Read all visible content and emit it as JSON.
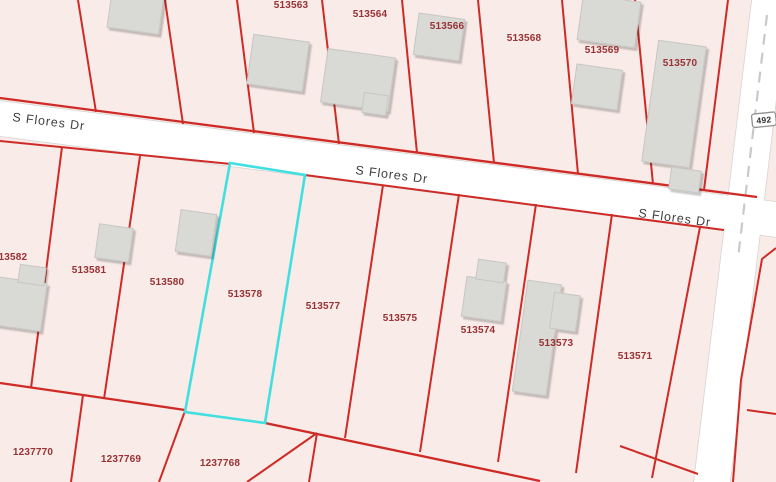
{
  "street": {
    "name": "S Flores Dr",
    "route_shield": "492"
  },
  "parcels": {
    "highlighted_id": "513578",
    "labels": [
      "513563",
      "513564",
      "513566",
      "513568",
      "513569",
      "513570",
      "513582",
      "513581",
      "513580",
      "513578",
      "513577",
      "513575",
      "513574",
      "513573",
      "513571",
      "1237770",
      "1237769",
      "1237768"
    ]
  },
  "colors": {
    "boundary_red": "#cf2b26",
    "highlight_cyan": "#41dfe0",
    "label_red": "#9a3134",
    "parcel_fill": "#f8ebe8",
    "road_fill": "#ffffff",
    "road_casing": "#d8d4d1",
    "building_fill": "#d9d9d6"
  }
}
